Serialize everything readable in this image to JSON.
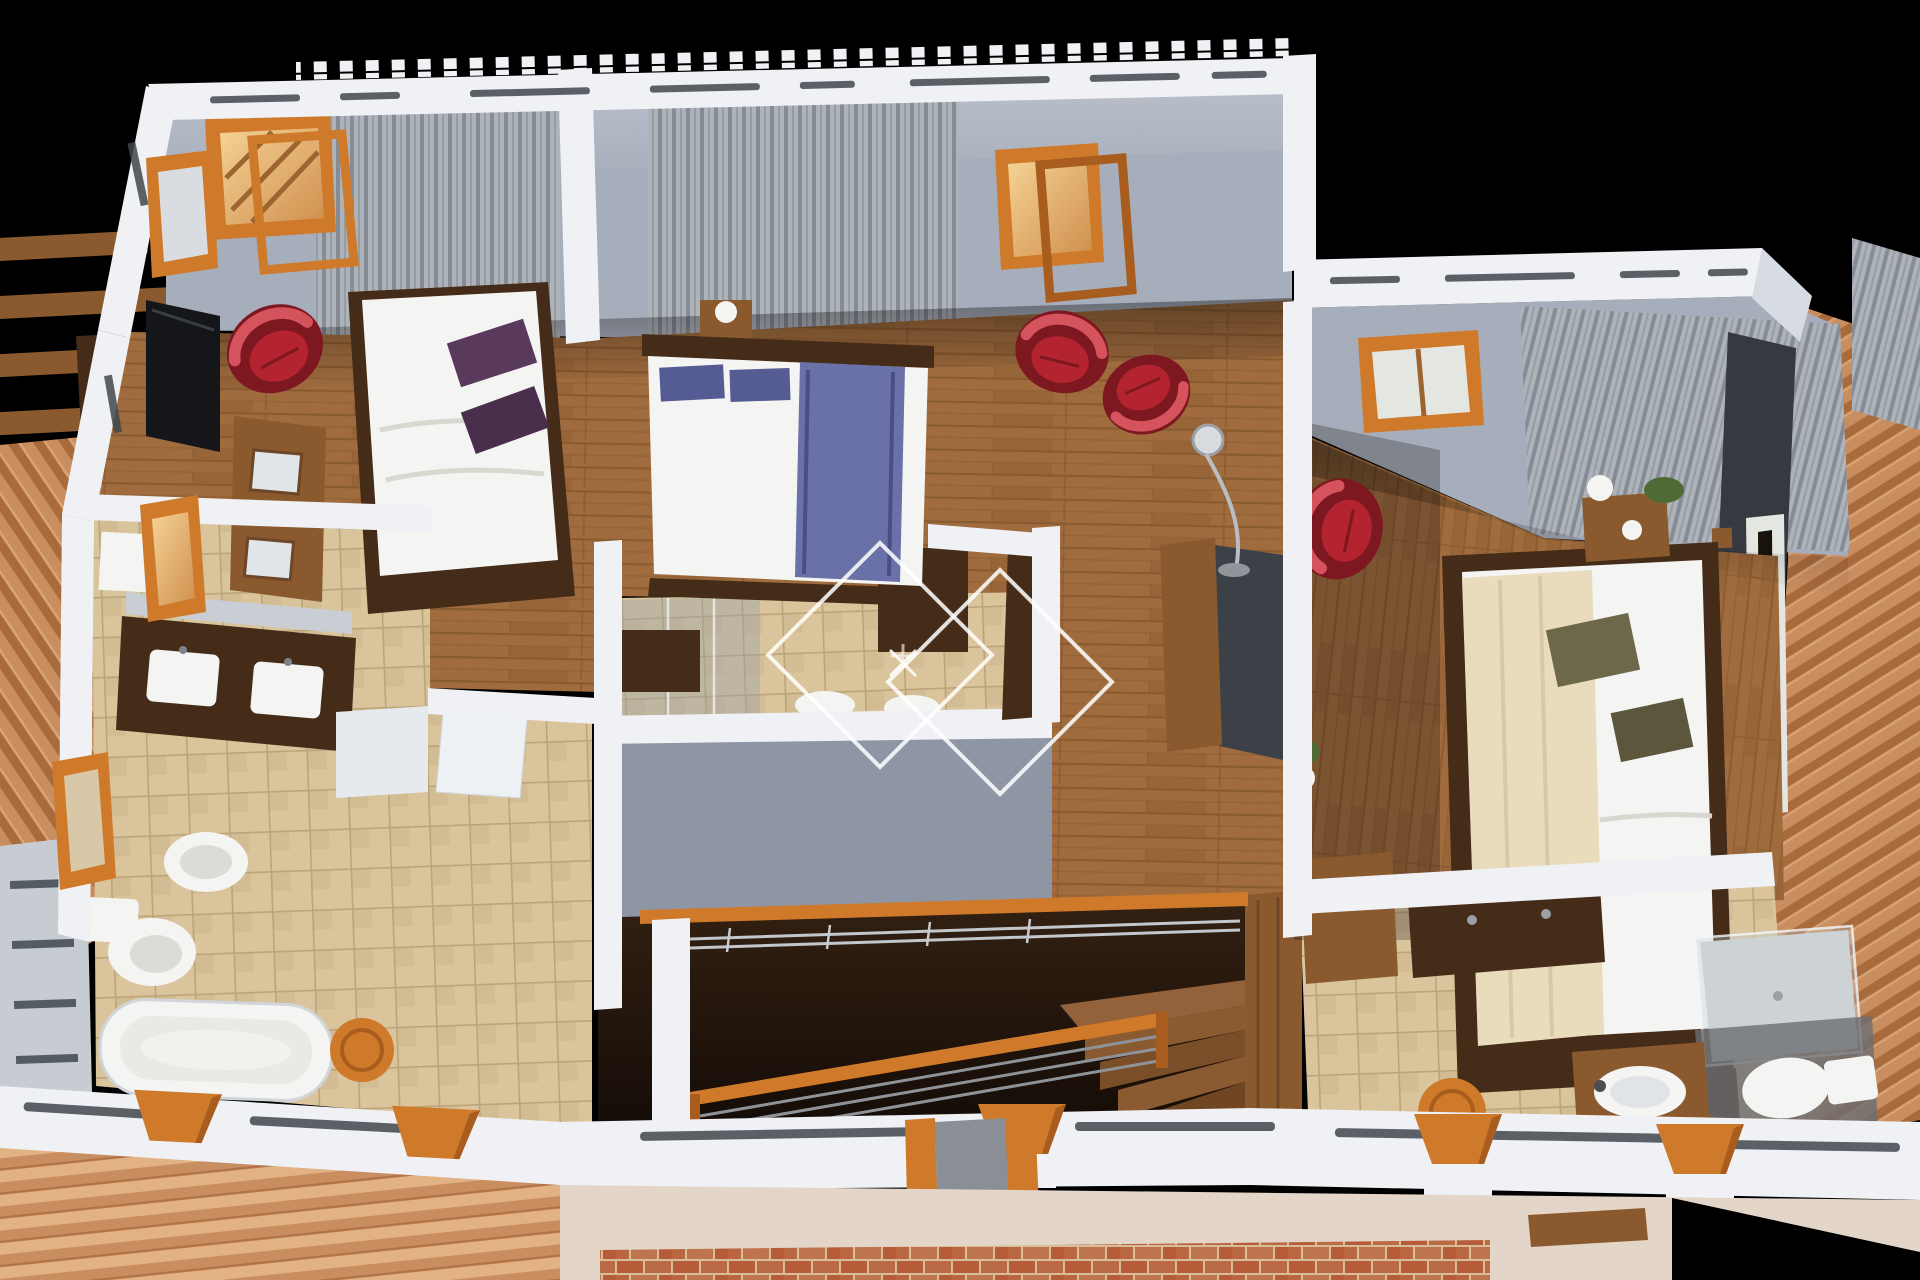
{
  "scene": {
    "description": "Isometric 3D cutaway rendering of a house upper floor plan on a black background, with terracotta roofs, wooden floors, grey walls with white caps, and furnished rooms",
    "rooms": [
      "bedroom-left",
      "bedroom-middle",
      "bedroom-right",
      "ensuite-bathroom-left",
      "ensuite-bathroom-middle",
      "bathroom-right",
      "walk-in-wardrobe",
      "hallway-landing",
      "staircase",
      "balcony-terrace"
    ],
    "furniture_and_fixtures": [
      "double-bed-white-purple-pillows",
      "double-bed-white-blue-runner",
      "double-bed-white-olive-pillows-cream-throw",
      "red-armchair-x4",
      "wall-tv",
      "dresser-with-frames",
      "nightstand-with-lamp-x2",
      "double-vanity-two-sinks",
      "bidet",
      "toilet-x3",
      "bathtub",
      "glass-shower",
      "basin-on-cabinet",
      "wooden-stool-x2",
      "floor-lamp",
      "wardrobe-rail-with-hangers",
      "stair-handrail",
      "wooden-steps",
      "shelf-unit",
      "potted-plants",
      "vases",
      "fireplace-panel",
      "balcony-corbels",
      "pergola-beams"
    ],
    "materials": [
      "wood-plank-flooring",
      "beige-floor-tiles",
      "terracotta-roof-tiles",
      "brick-paving",
      "grey-vertical-curtains",
      "white-wall-caps-with-vent-slots",
      "crenellated-tile-roof-edge"
    ],
    "watermark": {
      "type": "double-diamond-outline-with-sparkle",
      "color": "rgba(255,255,255,0.85)"
    }
  },
  "colors": {
    "bg": "#000000",
    "cap": "#eff1f4",
    "cap-shade": "#d7dbe2",
    "wall": "#a7aebb",
    "wall-dark": "#8e96a5",
    "wood-a": "#a06c3e",
    "wood-b": "#8f5e33",
    "wood-line": "#774c26",
    "wood-mid": "#8a5a2e",
    "wood-dark": "#452c18",
    "corbel": "#cf7a2a",
    "corbel-dark": "#a85c1d",
    "tile-a": "#d9c49c",
    "tile-b": "#ccb68e",
    "tile-line": "#bca479",
    "roof1": "#c98e60",
    "roof2": "#a96a3c",
    "roof3": "#e2b184",
    "brick1": "#b65c38",
    "brick2": "#d9bd96",
    "curt1": "#aeb3ba",
    "curt2": "#858c96",
    "red": "#b32430",
    "red-dark": "#7d1820",
    "red-hi": "#d4535c",
    "blue": "#6a70a8",
    "blue-dark": "#555b93",
    "purple": "#5a3a5c",
    "purple-dark": "#4a2f4c",
    "olive": "#6e684a",
    "olive-dark": "#5c563c",
    "cream": "#e9dcbd",
    "white-fix": "#f4f4f2",
    "white-soft": "#e4e6e2",
    "charcoal": "#36393f",
    "metal": "#c3c7cb",
    "glow1": "#f5d395",
    "glow2": "#cf8f4e",
    "green": "#4e6b35",
    "void1": "#342112",
    "void2": "#0e0805"
  }
}
